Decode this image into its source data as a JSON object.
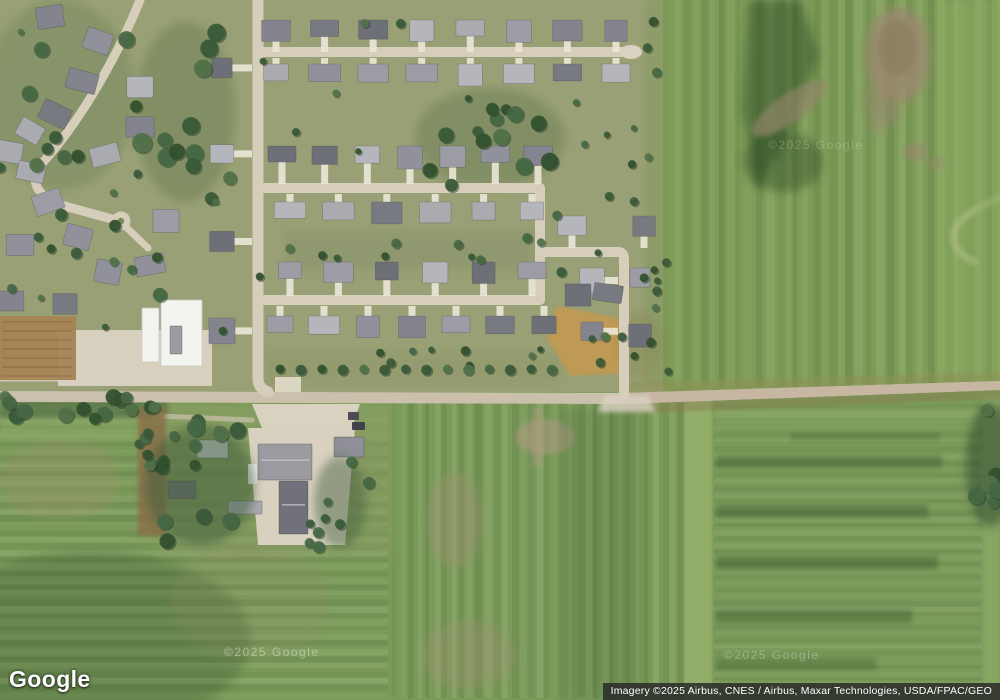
{
  "logo": {
    "text": "Google"
  },
  "attribution": {
    "text": "Imagery ©2025 Airbus, CNES / Airbus, Maxar Technologies, USDA/FPAC/GEO"
  },
  "map": {
    "type": "satellite-imagery",
    "watermarks": [
      {
        "text": "©2025 Google",
        "x": 224,
        "y": 645,
        "opacity": 0.38
      },
      {
        "text": "©2025 Google",
        "x": 724,
        "y": 648,
        "opacity": 0.28
      },
      {
        "text": "©2025 Google",
        "x": 768,
        "y": 138,
        "opacity": 0.2
      }
    ],
    "colors": {
      "nbhd": "#99a075",
      "fieldRight": "#7e9c58",
      "fieldBottom": "#7a9a5a",
      "stripeDark": "#2c4a26",
      "stripeLight": "#d8e6b0",
      "road": "#cbc0ac",
      "roadRight": "#c6b4a0",
      "street": "#d6cdba",
      "drive": "#eae5d7",
      "gravel": "#d9d2c1",
      "treeShadow": "#273f28",
      "trees": [
        "#3a5a3a",
        "#466844",
        "#52724a",
        "#33512f"
      ],
      "house": [
        "#90919a",
        "#83848d",
        "#9c9da4",
        "#aaabb1",
        "#787a82",
        "#b5b6bc",
        "#6e7078"
      ],
      "white": "#f3f3ef"
    },
    "scene": {
      "bases": [
        {
          "x": 0,
          "y": 387,
          "w": 1000,
          "h": 313,
          "f": "#7a9a5a"
        },
        {
          "x": 663,
          "y": 0,
          "w": 337,
          "h": 390,
          "f": "#7e9c58"
        },
        {
          "x": 0,
          "y": 0,
          "w": 663,
          "h": 392,
          "f": "#99a075"
        }
      ],
      "stripes": [
        {
          "x0": 663,
          "x1": 1000,
          "y0": 0,
          "y1": 387,
          "dir": "v",
          "step": 9,
          "seed": 7,
          "op": 0.1
        },
        {
          "x0": 0,
          "x1": 388,
          "y0": 410,
          "y1": 698,
          "dir": "h",
          "step": 7,
          "seed": 11,
          "op": 0.1
        },
        {
          "x0": 392,
          "x1": 684,
          "y0": 402,
          "y1": 698,
          "dir": "v",
          "step": 8,
          "seed": 23,
          "op": 0.1
        },
        {
          "x0": 714,
          "x1": 982,
          "y0": 405,
          "y1": 695,
          "dir": "h",
          "step": 6,
          "seed": 31,
          "op": 0.07
        }
      ],
      "patches": [
        {
          "k": "e",
          "cx": 490,
          "cy": 138,
          "rx": 75,
          "ry": 50,
          "f": "#5e7549",
          "o": 0.38,
          "b": 6
        },
        {
          "k": "e",
          "cx": 60,
          "cy": 95,
          "rx": 75,
          "ry": 95,
          "f": "#647a4e",
          "o": 0.32,
          "b": 6
        },
        {
          "k": "e",
          "cx": 185,
          "cy": 112,
          "rx": 50,
          "ry": 90,
          "f": "#5e7549",
          "o": 0.38,
          "b": 6
        },
        {
          "k": "r",
          "x": 285,
          "y": 230,
          "w": 250,
          "h": 40,
          "f": "#879069",
          "o": 0.45,
          "b": 6
        },
        {
          "k": "r",
          "x": 265,
          "y": 352,
          "w": 295,
          "h": 32,
          "f": "#8b9468",
          "o": 0.4,
          "b": 6
        },
        {
          "k": "r",
          "x": 645,
          "y": 0,
          "w": 22,
          "h": 385,
          "f": "#84995e",
          "o": 0.55,
          "b": 3
        },
        {
          "k": "p",
          "pts": "748,0 802,0 818,55 795,125 757,190 742,110",
          "f": "#24431f",
          "o": 0.45,
          "b": 6
        },
        {
          "k": "e",
          "cx": 783,
          "cy": 162,
          "rx": 40,
          "ry": 30,
          "f": "#2a4724",
          "o": 0.4,
          "b": 6
        },
        {
          "k": "e",
          "cx": 898,
          "cy": 55,
          "rx": 33,
          "ry": 48,
          "f": "#9b8870",
          "o": 0.8,
          "b": 6
        },
        {
          "k": "e",
          "cx": 897,
          "cy": 48,
          "rx": 19,
          "ry": 28,
          "f": "#8d7a60",
          "o": 0.6,
          "b": 3
        },
        {
          "k": "p",
          "pts": "862,92 888,78 902,118 872,136",
          "f": "#97866d",
          "o": 0.55,
          "b": 6
        },
        {
          "k": "e",
          "cx": 790,
          "cy": 108,
          "rx": 45,
          "ry": 14,
          "f": "#97866d",
          "o": 0.6,
          "b": 3,
          "rot": -35
        },
        {
          "k": "e",
          "cx": 916,
          "cy": 152,
          "rx": 13,
          "ry": 9,
          "f": "#9a8870",
          "o": 0.55,
          "b": 3
        },
        {
          "k": "e",
          "cx": 938,
          "cy": 163,
          "rx": 9,
          "ry": 7,
          "f": "#9a8870",
          "o": 0.5,
          "b": 3
        },
        {
          "k": "r",
          "x": 940,
          "y": 0,
          "w": 34,
          "h": 380,
          "f": "#93b162",
          "o": 0.4,
          "b": 6
        },
        {
          "k": "s",
          "d": "M1000,198 C950,215 938,245 975,262",
          "f": "#b9c490",
          "w": 7,
          "o": 0.5,
          "b": 3
        },
        {
          "k": "r",
          "x": 976,
          "y": 0,
          "w": 24,
          "h": 385,
          "f": "#8cab62",
          "o": 0.45,
          "b": 3
        },
        {
          "k": "p",
          "pts": "556,306 618,318 626,373 570,376 547,338",
          "f": "#c09a52",
          "o": 0.95,
          "b": 2
        },
        {
          "k": "e",
          "cx": 640,
          "cy": 345,
          "rx": 22,
          "ry": 34,
          "f": "#8a8852",
          "o": 0.4,
          "b": 6
        },
        {
          "k": "r",
          "x": 0,
          "y": 406,
          "w": 388,
          "h": 36,
          "f": "#8ca766",
          "o": 0.55,
          "b": 3
        },
        {
          "k": "e",
          "cx": 90,
          "cy": 640,
          "rx": 160,
          "ry": 90,
          "f": "#1e3c1e",
          "o": 0.22,
          "b": 6
        },
        {
          "k": "e",
          "cx": 60,
          "cy": 480,
          "rx": 60,
          "ry": 40,
          "f": "#a88f6e",
          "o": 0.26,
          "b": 6
        },
        {
          "k": "e",
          "cx": 250,
          "cy": 600,
          "rx": 80,
          "ry": 60,
          "f": "#9a8a68",
          "o": 0.2,
          "b": 6
        },
        {
          "k": "e",
          "cx": 330,
          "cy": 470,
          "rx": 45,
          "ry": 55,
          "f": "#a08a66",
          "o": 0.2,
          "b": 6
        },
        {
          "k": "e",
          "cx": 545,
          "cy": 437,
          "rx": 30,
          "ry": 18,
          "f": "#b49a84",
          "o": 0.5,
          "b": 3
        },
        {
          "k": "e",
          "cx": 455,
          "cy": 520,
          "rx": 28,
          "ry": 48,
          "f": "#a98f78",
          "o": 0.34,
          "b": 6
        },
        {
          "k": "e",
          "cx": 468,
          "cy": 655,
          "rx": 48,
          "ry": 34,
          "f": "#ab9179",
          "o": 0.28,
          "b": 6
        },
        {
          "k": "r",
          "x": 560,
          "y": 408,
          "w": 80,
          "h": 292,
          "f": "#1e3c1e",
          "o": 0.13,
          "b": 6
        },
        {
          "k": "r",
          "x": 532,
          "y": 408,
          "w": 10,
          "h": 58,
          "f": "#b49a84",
          "o": 0.4,
          "b": 3
        },
        {
          "k": "r",
          "x": 684,
          "y": 398,
          "w": 28,
          "h": 302,
          "f": "#94b069",
          "o": 0.9,
          "b": 2
        },
        {
          "k": "r",
          "x": 714,
          "y": 408,
          "w": 266,
          "h": 14,
          "f": "#91ac68",
          "o": 0.5,
          "b": 3
        },
        {
          "k": "r",
          "x": 716,
          "y": 455,
          "w": 226,
          "h": 13,
          "f": "#22441f",
          "o": 0.3,
          "b": 3
        },
        {
          "k": "r",
          "x": 716,
          "y": 505,
          "w": 212,
          "h": 13,
          "f": "#22441f",
          "o": 0.3,
          "b": 3
        },
        {
          "k": "r",
          "x": 716,
          "y": 556,
          "w": 222,
          "h": 14,
          "f": "#22441f",
          "o": 0.32,
          "b": 3
        },
        {
          "k": "r",
          "x": 716,
          "y": 610,
          "w": 196,
          "h": 13,
          "f": "#22441f",
          "o": 0.3,
          "b": 3
        },
        {
          "k": "r",
          "x": 716,
          "y": 658,
          "w": 160,
          "h": 12,
          "f": "#22441f",
          "o": 0.26,
          "b": 3
        },
        {
          "k": "r",
          "x": 790,
          "y": 432,
          "w": 150,
          "h": 9,
          "f": "#22441f",
          "o": 0.18,
          "b": 3
        },
        {
          "k": "r",
          "x": 983,
          "y": 395,
          "w": 17,
          "h": 305,
          "f": "#8fae67",
          "o": 0.6,
          "b": 3
        },
        {
          "k": "e",
          "cx": 990,
          "cy": 465,
          "rx": 24,
          "ry": 62,
          "f": "#2f4a2e",
          "o": 0.55,
          "b": 6
        },
        {
          "k": "r",
          "x": 158,
          "y": 406,
          "w": 235,
          "h": 150,
          "f": "#8a9a63",
          "o": 0.5,
          "b": 6
        },
        {
          "k": "p",
          "pts": "622,382 1000,372 1000,381 622,393",
          "f": "#8e9156",
          "o": 0.5,
          "b": 2
        },
        {
          "k": "p",
          "pts": "622,404 1000,390 1000,399 622,414",
          "f": "#8b7d50",
          "o": 0.45,
          "b": 2
        },
        {
          "k": "r",
          "x": 0,
          "y": 394,
          "w": 168,
          "h": 24,
          "f": "#44603c",
          "o": 0.5,
          "b": 3
        }
      ],
      "road": {
        "pts": "0,391 622,393 1000,381 1000,390 622,404 0,402",
        "f": "#cbc0ac",
        "right_pts": "622,393 1000,381 1000,390 622,404",
        "right_f": "#c6b4a0",
        "right_o": 0.85
      },
      "streets": [
        {
          "d": "M258,0 L258,380 Q259,389 268,392",
          "w": 11
        },
        {
          "d": "M262,52 L628,52",
          "w": 10
        },
        {
          "d": "M263,188 H540 V300 H263",
          "w": 10
        },
        {
          "d": "M540,252 H618 Q624,252 624,259 V394",
          "w": 10
        },
        {
          "d": "M140,0 C120,50 85,115 45,160 C25,182 38,198 68,207 L112,219",
          "w": 9
        },
        {
          "d": "M126,227 L148,248",
          "w": 7
        },
        {
          "d": "M0,378 L150,378",
          "w": 7,
          "c": "#cfc6b2"
        }
      ],
      "culdesac": {
        "cx": 121,
        "cy": 221,
        "r": 9.5,
        "island": 3.2,
        "island_f": "#7d8a5f"
      },
      "gravel": [
        {
          "k": "e",
          "cx": 631,
          "cy": 52,
          "rx": 11,
          "ry": 7,
          "f": "#d9d2c1",
          "o": 1
        },
        {
          "k": "r",
          "x": 275,
          "y": 377,
          "w": 26,
          "h": 15,
          "f": "#e2dccb",
          "o": 0.9
        },
        {
          "k": "p",
          "pts": "252,404 360,404 352,428 262,428",
          "f": "#d9d2c1",
          "o": 1
        },
        {
          "k": "r",
          "x": 286,
          "y": 426,
          "w": 14,
          "h": 22,
          "f": "#d9d2c1",
          "o": 0.95
        },
        {
          "k": "p",
          "pts": "248,428 355,428 345,545 258,545",
          "f": "#d8d1c0",
          "o": 1
        },
        {
          "k": "p",
          "pts": "604,395 648,395 656,412 598,412",
          "f": "#d9d2c1",
          "o": 0.8,
          "b": 3
        },
        {
          "k": "r",
          "x": 58,
          "y": 330,
          "w": 154,
          "h": 56,
          "f": "#d7d0bf",
          "o": 1
        },
        {
          "k": "s",
          "d": "M160,416 L252,420",
          "f": "#cbc2ae",
          "w": 5,
          "o": 0.7
        }
      ],
      "dirt": [
        {
          "x": 0,
          "y": 316,
          "w": 76,
          "h": 64,
          "f": "#a58454",
          "o": 0.95,
          "furrows": true
        },
        {
          "x": 138,
          "y": 408,
          "w": 28,
          "h": 128,
          "f": "#8a7048",
          "o": 0.85,
          "b": 3
        }
      ],
      "white_buildings": [
        {
          "x": 142,
          "y": 308,
          "w": 17,
          "h": 54
        },
        {
          "x": 161,
          "y": 300,
          "w": 41,
          "h": 66
        }
      ],
      "farm_buildings": [
        {
          "x": 197,
          "y": 440,
          "w": 31,
          "h": 18,
          "f": "#cfd0d4"
        },
        {
          "x": 258,
          "y": 444,
          "w": 54,
          "h": 36,
          "f": "#9a9aa0",
          "ridge": true
        },
        {
          "x": 279,
          "y": 481,
          "w": 29,
          "h": 53,
          "f": "#70717a",
          "ridge": true
        },
        {
          "x": 334,
          "y": 437,
          "w": 30,
          "h": 20,
          "f": "#8f9097"
        },
        {
          "x": 168,
          "y": 481,
          "w": 28,
          "h": 18,
          "f": "#72737b"
        },
        {
          "x": 228,
          "y": 501,
          "w": 34,
          "h": 13,
          "f": "#a8a9ae"
        },
        {
          "x": 170,
          "y": 326,
          "w": 12,
          "h": 28,
          "f": "#9a9aa0"
        }
      ],
      "vehicles": [
        {
          "x": 348,
          "y": 412,
          "w": 11,
          "h": 8,
          "f": "#4c4c54"
        },
        {
          "x": 352,
          "y": 422,
          "w": 13,
          "h": 8,
          "f": "#414149"
        },
        {
          "x": 248,
          "y": 464,
          "w": 9,
          "h": 20,
          "f": "#e9e9e6"
        }
      ],
      "house_rows": [
        {
          "x0": 276,
          "x1": 616,
          "y": 20,
          "n": 8,
          "drive": 52
        },
        {
          "x0": 276,
          "x1": 616,
          "y": 64,
          "n": 8,
          "drive": 58
        },
        {
          "x0": 282,
          "x1": 538,
          "y": 146,
          "n": 7,
          "drive": 184
        },
        {
          "x0": 290,
          "x1": 532,
          "y": 202,
          "n": 6,
          "drive": 194
        },
        {
          "x0": 290,
          "x1": 532,
          "y": 262,
          "n": 6,
          "drive": 296
        },
        {
          "x0": 280,
          "x1": 544,
          "y": 316,
          "n": 7,
          "drive": 306
        },
        {
          "x0": 572,
          "x1": 644,
          "y": 216,
          "n": 2,
          "drive": 248
        }
      ],
      "house_cols": [
        {
          "y0": 268,
          "y1": 324,
          "x": 640,
          "n": 2,
          "drive": 630
        },
        {
          "y0": 268,
          "y1": 322,
          "x": 592,
          "n": 2,
          "drive": 618
        },
        {
          "y0": 58,
          "y1": 318,
          "x": 222,
          "n": 4,
          "drive": 252
        }
      ],
      "houses_organic": [
        [
          50,
          8,
          -8
        ],
        [
          98,
          32,
          20
        ],
        [
          82,
          72,
          15
        ],
        [
          140,
          78,
          0
        ],
        [
          55,
          105,
          25
        ],
        [
          140,
          118,
          0
        ],
        [
          30,
          122,
          30
        ],
        [
          10,
          143,
          10
        ],
        [
          105,
          146,
          -15
        ],
        [
          31,
          163,
          12
        ],
        [
          48,
          193,
          -20
        ],
        [
          78,
          228,
          15
        ],
        [
          20,
          236,
          0
        ],
        [
          108,
          263,
          10
        ],
        [
          150,
          256,
          -10
        ],
        [
          166,
          212,
          0
        ],
        [
          65,
          295,
          0
        ],
        [
          8,
          292,
          0
        ],
        [
          578,
          286,
          0
        ],
        [
          608,
          284,
          8
        ]
      ],
      "tree_underlays": [
        {
          "k": "e",
          "cx": 200,
          "cy": 485,
          "rx": 55,
          "ry": 60,
          "f": "#3f5c3a",
          "o": 0.5,
          "b": 6
        },
        {
          "k": "e",
          "cx": 340,
          "cy": 502,
          "rx": 26,
          "ry": 46,
          "f": "#3f5c3a",
          "o": 0.45,
          "b": 6
        }
      ],
      "tree_clusters": [
        [
          0,
          0,
          140,
          205,
          10,
          5,
          9
        ],
        [
          140,
          20,
          230,
          210,
          12,
          6,
          10
        ],
        [
          425,
          88,
          558,
          186,
          13,
          5,
          9
        ],
        [
          20,
          210,
          160,
          312,
          8,
          4,
          7
        ],
        [
          4,
          4,
          650,
          378,
          26,
          3,
          5
        ],
        [
          286,
          236,
          544,
          262,
          6,
          3,
          5
        ],
        [
          272,
          338,
          558,
          366,
          8,
          3,
          5
        ],
        [
          642,
          6,
          670,
          380,
          12,
          3,
          5
        ],
        [
          150,
          418,
          250,
          548,
          13,
          5,
          9
        ],
        [
          308,
          458,
          372,
          548,
          9,
          4,
          7
        ],
        [
          2,
          395,
          165,
          420,
          14,
          5,
          8
        ],
        [
          138,
          420,
          168,
          538,
          7,
          4,
          6
        ],
        [
          976,
          404,
          1000,
          528,
          7,
          6,
          10
        ],
        [
          562,
          120,
          640,
          205,
          5,
          3,
          5
        ],
        [
          586,
          336,
          648,
          382,
          5,
          3,
          5
        ]
      ],
      "road_trees": {
        "x0": 280,
        "x1": 552,
        "y": 369,
        "n": 14,
        "r": 4.5
      }
    }
  }
}
